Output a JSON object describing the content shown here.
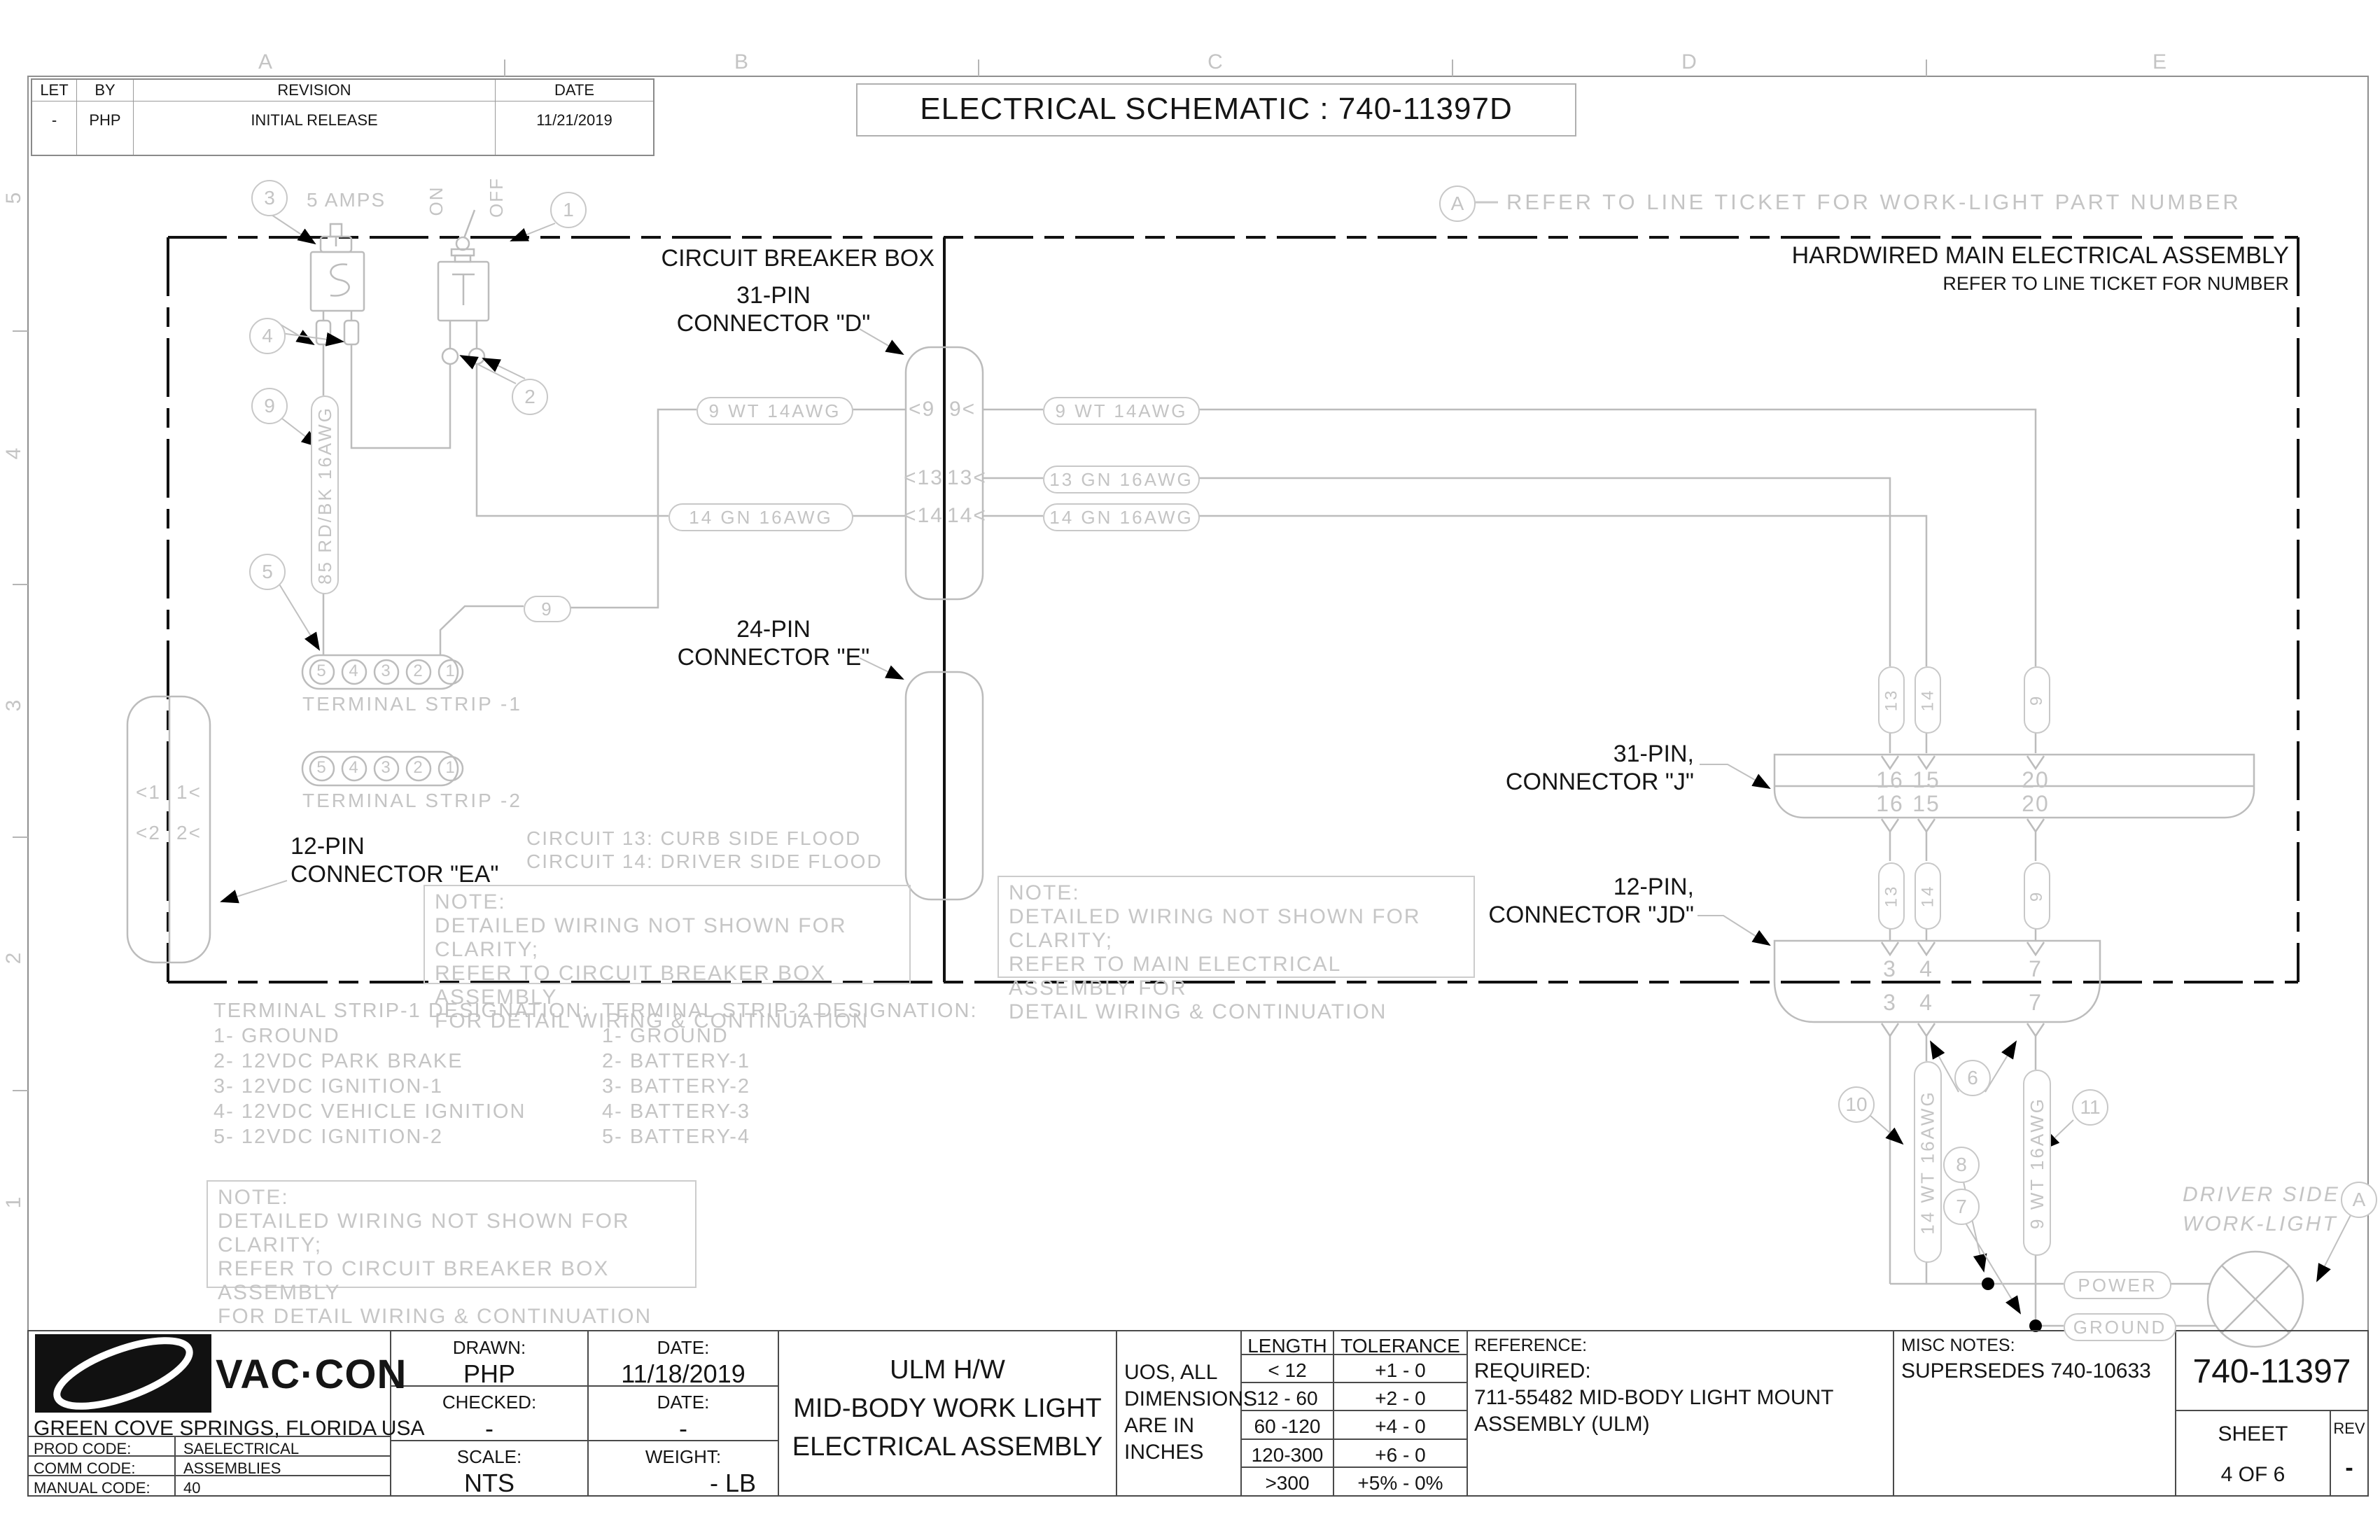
{
  "sheet": {
    "zone_columns": [
      "A",
      "B",
      "C",
      "D",
      "E"
    ],
    "zone_rows": [
      "5",
      "4",
      "3",
      "2",
      "1"
    ]
  },
  "revision_table": {
    "headers": [
      "LET",
      "BY",
      "REVISION",
      "DATE"
    ],
    "row": [
      "-",
      "PHP",
      "INITIAL RELEASE",
      "11/21/2019"
    ]
  },
  "drawing_title": "ELECTRICAL SCHEMATIC : 740-11397D",
  "work_light_note": {
    "balloon": "A",
    "text": "REFER TO LINE TICKET FOR WORK-LIGHT PART NUMBER"
  },
  "breaker_box": {
    "title": "CIRCUIT BREAKER BOX",
    "balloons": {
      "breaker_circuit": "3",
      "switch": "1",
      "breaker_terminals": "4",
      "switch_terminals": "2",
      "wire85": "9",
      "strip1": "5"
    },
    "amps_label": "5 AMPS",
    "switch_on": "ON",
    "switch_off": "OFF",
    "wire_85_label": "85 RD/BK 16AWG",
    "wire_9_tag": "9",
    "terminal_strip_1": {
      "pins": [
        "5",
        "4",
        "3",
        "2",
        "1"
      ],
      "label": "TERMINAL STRIP -1"
    },
    "terminal_strip_2": {
      "pins": [
        "5",
        "4",
        "3",
        "2",
        "1"
      ],
      "label": "TERMINAL STRIP -2"
    },
    "connector_ea": {
      "label_line1": "12-PIN",
      "label_line2": "CONNECTOR \"EA\"",
      "pins_left": [
        "<1",
        "<2"
      ],
      "pins_right": [
        "1<",
        "2<"
      ]
    },
    "circuit_13": "CIRCUIT 13: CURB SIDE FLOOD",
    "circuit_14": "CIRCUIT 14: DRIVER SIDE FLOOD",
    "note": [
      "NOTE:",
      "DETAILED WIRING NOT SHOWN FOR CLARITY;",
      "REFER TO CIRCUIT BREAKER BOX ASSEMBLY",
      "FOR DETAIL WIRING & CONTINUATION"
    ]
  },
  "main_box": {
    "title": "HARDWIRED MAIN ELECTRICAL ASSEMBLY",
    "subtitle": "REFER TO LINE TICKET FOR NUMBER",
    "note": [
      "NOTE:",
      "DETAILED WIRING NOT SHOWN FOR CLARITY;",
      "REFER TO MAIN ELECTRICAL ASSEMBLY FOR",
      "DETAIL WIRING & CONTINUATION"
    ]
  },
  "connector_d": {
    "label_line1": "31-PIN",
    "label_line2": "CONNECTOR \"D\"",
    "pins_left": [
      "<9",
      "<13",
      "<14"
    ],
    "pins_right": [
      "9<",
      "13<",
      "14<"
    ],
    "wire_left_9": "9 WT 14AWG",
    "wire_left_14": "14 GN 16AWG",
    "wire_right_9": "9 WT 14AWG",
    "wire_right_13": "13 GN 16AWG",
    "wire_right_14": "14 GN 16AWG"
  },
  "connector_e": {
    "label_line1": "24-PIN",
    "label_line2": "CONNECTOR \"E\""
  },
  "connector_j": {
    "label_line1": "31-PIN,",
    "label_line2": "CONNECTOR \"J\"",
    "wire_tags": [
      "13",
      "14",
      "9"
    ],
    "pins_top": [
      "16",
      "15",
      "20"
    ],
    "pins_bottom": [
      "16",
      "15",
      "20"
    ]
  },
  "connector_jd": {
    "label_line1": "12-PIN,",
    "label_line2": "CONNECTOR \"JD\"",
    "wire_tags": [
      "13",
      "14",
      "9"
    ],
    "pins_top": [
      "3",
      "4",
      "7"
    ],
    "pins_bottom": [
      "3",
      "4",
      "7"
    ]
  },
  "work_light_area": {
    "balloons": {
      "b10": "10",
      "b6": "6",
      "b11": "11",
      "b8": "8",
      "b7": "7",
      "a": "A"
    },
    "wire_14": "14 WT 16AWG",
    "wire_9": "9 WT 16AWG",
    "light_label_line1": "DRIVER SIDE",
    "light_label_line2": "WORK-LIGHT",
    "power": "POWER",
    "ground": "GROUND"
  },
  "designations": {
    "strip1": {
      "title": "TERMINAL STRIP-1 DESIGNATION:",
      "items": [
        "1- GROUND",
        "2- 12VDC PARK BRAKE",
        "3- 12VDC IGNITION-1",
        "4- 12VDC VEHICLE IGNITION",
        "5- 12VDC IGNITION-2"
      ]
    },
    "strip2": {
      "title": "TERMINAL STRIP-2 DESIGNATION:",
      "items": [
        "1- GROUND",
        "2- BATTERY-1",
        "3- BATTERY-2",
        "4- BATTERY-3",
        "5- BATTERY-4"
      ]
    }
  },
  "bottom_note": [
    "NOTE:",
    "DETAILED WIRING NOT SHOWN FOR CLARITY;",
    "REFER TO CIRCUIT BREAKER BOX ASSEMBLY",
    "FOR DETAIL WIRING & CONTINUATION"
  ],
  "title_block": {
    "company": "VAC·CON",
    "location": "GREEN COVE SPRINGS, FLORIDA USA",
    "codes": [
      {
        "label": "PROD CODE:",
        "value": "SAELECTRICAL"
      },
      {
        "label": "COMM CODE:",
        "value": "ASSEMBLIES"
      },
      {
        "label": "MANUAL CODE:",
        "value": "40"
      }
    ],
    "drawn_label": "DRAWN:",
    "drawn": "PHP",
    "drawn_date_label": "DATE:",
    "drawn_date": "11/18/2019",
    "checked_label": "CHECKED:",
    "checked": "-",
    "checked_date_label": "DATE:",
    "checked_date": "-",
    "scale_label": "SCALE:",
    "scale": "NTS",
    "weight_label": "WEIGHT:",
    "weight": "- LB",
    "title_lines": [
      "ULM H/W",
      "MID-BODY WORK LIGHT",
      "ELECTRICAL ASSEMBLY"
    ],
    "uos_lines": [
      "UOS, ALL",
      "DIMENSIONS",
      "ARE IN",
      "INCHES"
    ],
    "tolerance": {
      "headers": [
        "LENGTH",
        "TOLERANCE"
      ],
      "rows": [
        [
          "< 12",
          "+1 - 0"
        ],
        [
          "12 - 60",
          "+2 - 0"
        ],
        [
          "60 -120",
          "+4 - 0"
        ],
        [
          "120-300",
          "+6 - 0"
        ],
        [
          ">300",
          "+5% - 0%"
        ]
      ]
    },
    "reference_label": "REFERENCE:",
    "reference_lines": [
      "REQUIRED:",
      "711-55482 MID-BODY LIGHT MOUNT",
      "ASSEMBLY (ULM)"
    ],
    "misc_label": "MISC NOTES:",
    "misc": "SUPERSEDES 740-10633",
    "part_number": "740-11397",
    "sheet_label": "SHEET",
    "sheet": "4 OF 6",
    "rev_label": "REV",
    "rev": "-"
  }
}
